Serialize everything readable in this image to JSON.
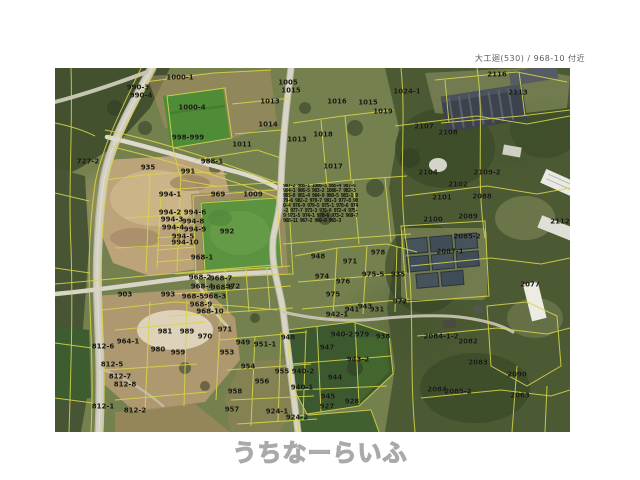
{
  "header": {
    "title": "大工廻(530) / 968-10 付近"
  },
  "watermark": {
    "text": "うちなーらいふ"
  },
  "map": {
    "colors": {
      "boundary_yellow": "#d8d648",
      "label_black": "#17170f",
      "road_gray": "#d2cfc1",
      "quarry_tan": "#bda37a",
      "forest_green": "#43512f",
      "field_green": "#5c9340",
      "base_olive": "#75804f"
    },
    "dense_cluster": {
      "tokens": "987-2 986-1 1086-3 985-4 987-6 984-1 986-5 983-2 1086-7 982-3 985-8 981-4 984-9 980-5 983-1 979-6 982-2 978-7 981-3 977-8 980-4 976-9 979-5 975-1 978-6 974-2 977-7 973-3 976-8 972-4 975-9 971-5 974-1 970-6 973-2 969-7 968-11 967-2 966-8 965-3"
    },
    "parcels": [
      {
        "t": "990-3",
        "x": 83,
        "y": 20
      },
      {
        "t": "990-4",
        "x": 86,
        "y": 28
      },
      {
        "t": "1000-1",
        "x": 125,
        "y": 10
      },
      {
        "t": "1000-4",
        "x": 137,
        "y": 40
      },
      {
        "t": "1011",
        "x": 187,
        "y": 77
      },
      {
        "t": "998-999",
        "x": 133,
        "y": 70
      },
      {
        "t": "988-1",
        "x": 157,
        "y": 94
      },
      {
        "t": "935",
        "x": 93,
        "y": 100
      },
      {
        "t": "991",
        "x": 133,
        "y": 104
      },
      {
        "t": "727-2",
        "x": 33,
        "y": 94
      },
      {
        "t": "1005",
        "x": 233,
        "y": 15
      },
      {
        "t": "1015",
        "x": 236,
        "y": 23
      },
      {
        "t": "1013",
        "x": 215,
        "y": 34
      },
      {
        "t": "1014",
        "x": 213,
        "y": 57
      },
      {
        "t": "1013",
        "x": 242,
        "y": 72
      },
      {
        "t": "1016",
        "x": 282,
        "y": 34
      },
      {
        "t": "1015",
        "x": 313,
        "y": 35
      },
      {
        "t": "1019",
        "x": 328,
        "y": 44
      },
      {
        "t": "1024-1",
        "x": 352,
        "y": 24
      },
      {
        "t": "1018",
        "x": 268,
        "y": 67
      },
      {
        "t": "1017",
        "x": 278,
        "y": 99
      },
      {
        "t": "2107",
        "x": 369,
        "y": 59
      },
      {
        "t": "2108",
        "x": 393,
        "y": 65
      },
      {
        "t": "2116",
        "x": 442,
        "y": 7
      },
      {
        "t": "2113",
        "x": 463,
        "y": 25
      },
      {
        "t": "2104",
        "x": 373,
        "y": 105
      },
      {
        "t": "2109-2",
        "x": 432,
        "y": 105
      },
      {
        "t": "2102",
        "x": 403,
        "y": 117
      },
      {
        "t": "2101",
        "x": 387,
        "y": 130
      },
      {
        "t": "2088",
        "x": 427,
        "y": 129
      },
      {
        "t": "2100",
        "x": 378,
        "y": 152
      },
      {
        "t": "2089",
        "x": 413,
        "y": 149
      },
      {
        "t": "2085-2",
        "x": 412,
        "y": 169
      },
      {
        "t": "2087-1",
        "x": 395,
        "y": 184
      },
      {
        "t": "2112",
        "x": 505,
        "y": 154
      },
      {
        "t": "994-1",
        "x": 115,
        "y": 127
      },
      {
        "t": "969",
        "x": 163,
        "y": 127
      },
      {
        "t": "1009",
        "x": 198,
        "y": 127
      },
      {
        "t": "992",
        "x": 172,
        "y": 164
      },
      {
        "t": "994-2",
        "x": 115,
        "y": 145
      },
      {
        "t": "994-6",
        "x": 140,
        "y": 145
      },
      {
        "t": "994-3",
        "x": 117,
        "y": 152
      },
      {
        "t": "994-8",
        "x": 138,
        "y": 154
      },
      {
        "t": "994-4",
        "x": 118,
        "y": 160
      },
      {
        "t": "994-9",
        "x": 140,
        "y": 162
      },
      {
        "t": "994-5",
        "x": 128,
        "y": 169
      },
      {
        "t": "994-10",
        "x": 130,
        "y": 175
      },
      {
        "t": "968-1",
        "x": 147,
        "y": 190
      },
      {
        "t": "968-2",
        "x": 145,
        "y": 210
      },
      {
        "t": "968-7",
        "x": 166,
        "y": 211
      },
      {
        "t": "968-4",
        "x": 147,
        "y": 219
      },
      {
        "t": "968-6",
        "x": 167,
        "y": 220
      },
      {
        "t": "972",
        "x": 178,
        "y": 219
      },
      {
        "t": "993",
        "x": 113,
        "y": 227
      },
      {
        "t": "968-5",
        "x": 138,
        "y": 229
      },
      {
        "t": "968-3",
        "x": 160,
        "y": 229
      },
      {
        "t": "968-9",
        "x": 146,
        "y": 237
      },
      {
        "t": "968-10",
        "x": 155,
        "y": 244
      },
      {
        "t": "903",
        "x": 70,
        "y": 227
      },
      {
        "t": "964-1",
        "x": 73,
        "y": 274
      },
      {
        "t": "812-6",
        "x": 48,
        "y": 279
      },
      {
        "t": "980",
        "x": 103,
        "y": 282
      },
      {
        "t": "959",
        "x": 123,
        "y": 285
      },
      {
        "t": "989",
        "x": 132,
        "y": 264
      },
      {
        "t": "981",
        "x": 110,
        "y": 264
      },
      {
        "t": "970",
        "x": 150,
        "y": 269
      },
      {
        "t": "971",
        "x": 170,
        "y": 262
      },
      {
        "t": "953",
        "x": 172,
        "y": 285
      },
      {
        "t": "812-5",
        "x": 57,
        "y": 297
      },
      {
        "t": "812-7",
        "x": 65,
        "y": 309
      },
      {
        "t": "812-8",
        "x": 70,
        "y": 317
      },
      {
        "t": "812-1",
        "x": 48,
        "y": 339
      },
      {
        "t": "812-2",
        "x": 80,
        "y": 343
      },
      {
        "t": "948",
        "x": 263,
        "y": 189
      },
      {
        "t": "971",
        "x": 295,
        "y": 194
      },
      {
        "t": "978",
        "x": 323,
        "y": 185
      },
      {
        "t": "974",
        "x": 267,
        "y": 209
      },
      {
        "t": "976",
        "x": 288,
        "y": 214
      },
      {
        "t": "975-5",
        "x": 318,
        "y": 207
      },
      {
        "t": "935",
        "x": 343,
        "y": 207
      },
      {
        "t": "975",
        "x": 278,
        "y": 227
      },
      {
        "t": "972",
        "x": 345,
        "y": 234
      },
      {
        "t": "941",
        "x": 297,
        "y": 242
      },
      {
        "t": "943",
        "x": 310,
        "y": 239
      },
      {
        "t": "931",
        "x": 322,
        "y": 242
      },
      {
        "t": "942-1",
        "x": 282,
        "y": 247
      },
      {
        "t": "940-2",
        "x": 287,
        "y": 267
      },
      {
        "t": "979",
        "x": 307,
        "y": 267
      },
      {
        "t": "938",
        "x": 328,
        "y": 269
      },
      {
        "t": "949",
        "x": 188,
        "y": 275
      },
      {
        "t": "951-1",
        "x": 210,
        "y": 277
      },
      {
        "t": "948",
        "x": 233,
        "y": 270
      },
      {
        "t": "947",
        "x": 272,
        "y": 280
      },
      {
        "t": "943-2",
        "x": 303,
        "y": 292
      },
      {
        "t": "954",
        "x": 193,
        "y": 299
      },
      {
        "t": "956",
        "x": 207,
        "y": 314
      },
      {
        "t": "955",
        "x": 227,
        "y": 304
      },
      {
        "t": "940-2",
        "x": 248,
        "y": 304
      },
      {
        "t": "944",
        "x": 280,
        "y": 310
      },
      {
        "t": "940-1",
        "x": 247,
        "y": 320
      },
      {
        "t": "958",
        "x": 180,
        "y": 324
      },
      {
        "t": "945",
        "x": 273,
        "y": 329
      },
      {
        "t": "927",
        "x": 272,
        "y": 339
      },
      {
        "t": "928",
        "x": 297,
        "y": 334
      },
      {
        "t": "957",
        "x": 177,
        "y": 342
      },
      {
        "t": "924-1",
        "x": 222,
        "y": 344
      },
      {
        "t": "924-2",
        "x": 242,
        "y": 350
      },
      {
        "t": "2084-1-2",
        "x": 386,
        "y": 269
      },
      {
        "t": "2082",
        "x": 413,
        "y": 274
      },
      {
        "t": "2083",
        "x": 423,
        "y": 295
      },
      {
        "t": "2084",
        "x": 382,
        "y": 322
      },
      {
        "t": "2085-2",
        "x": 403,
        "y": 324
      },
      {
        "t": "2090",
        "x": 462,
        "y": 307
      },
      {
        "t": "2063",
        "x": 465,
        "y": 328
      },
      {
        "t": "2077",
        "x": 475,
        "y": 217
      }
    ]
  }
}
